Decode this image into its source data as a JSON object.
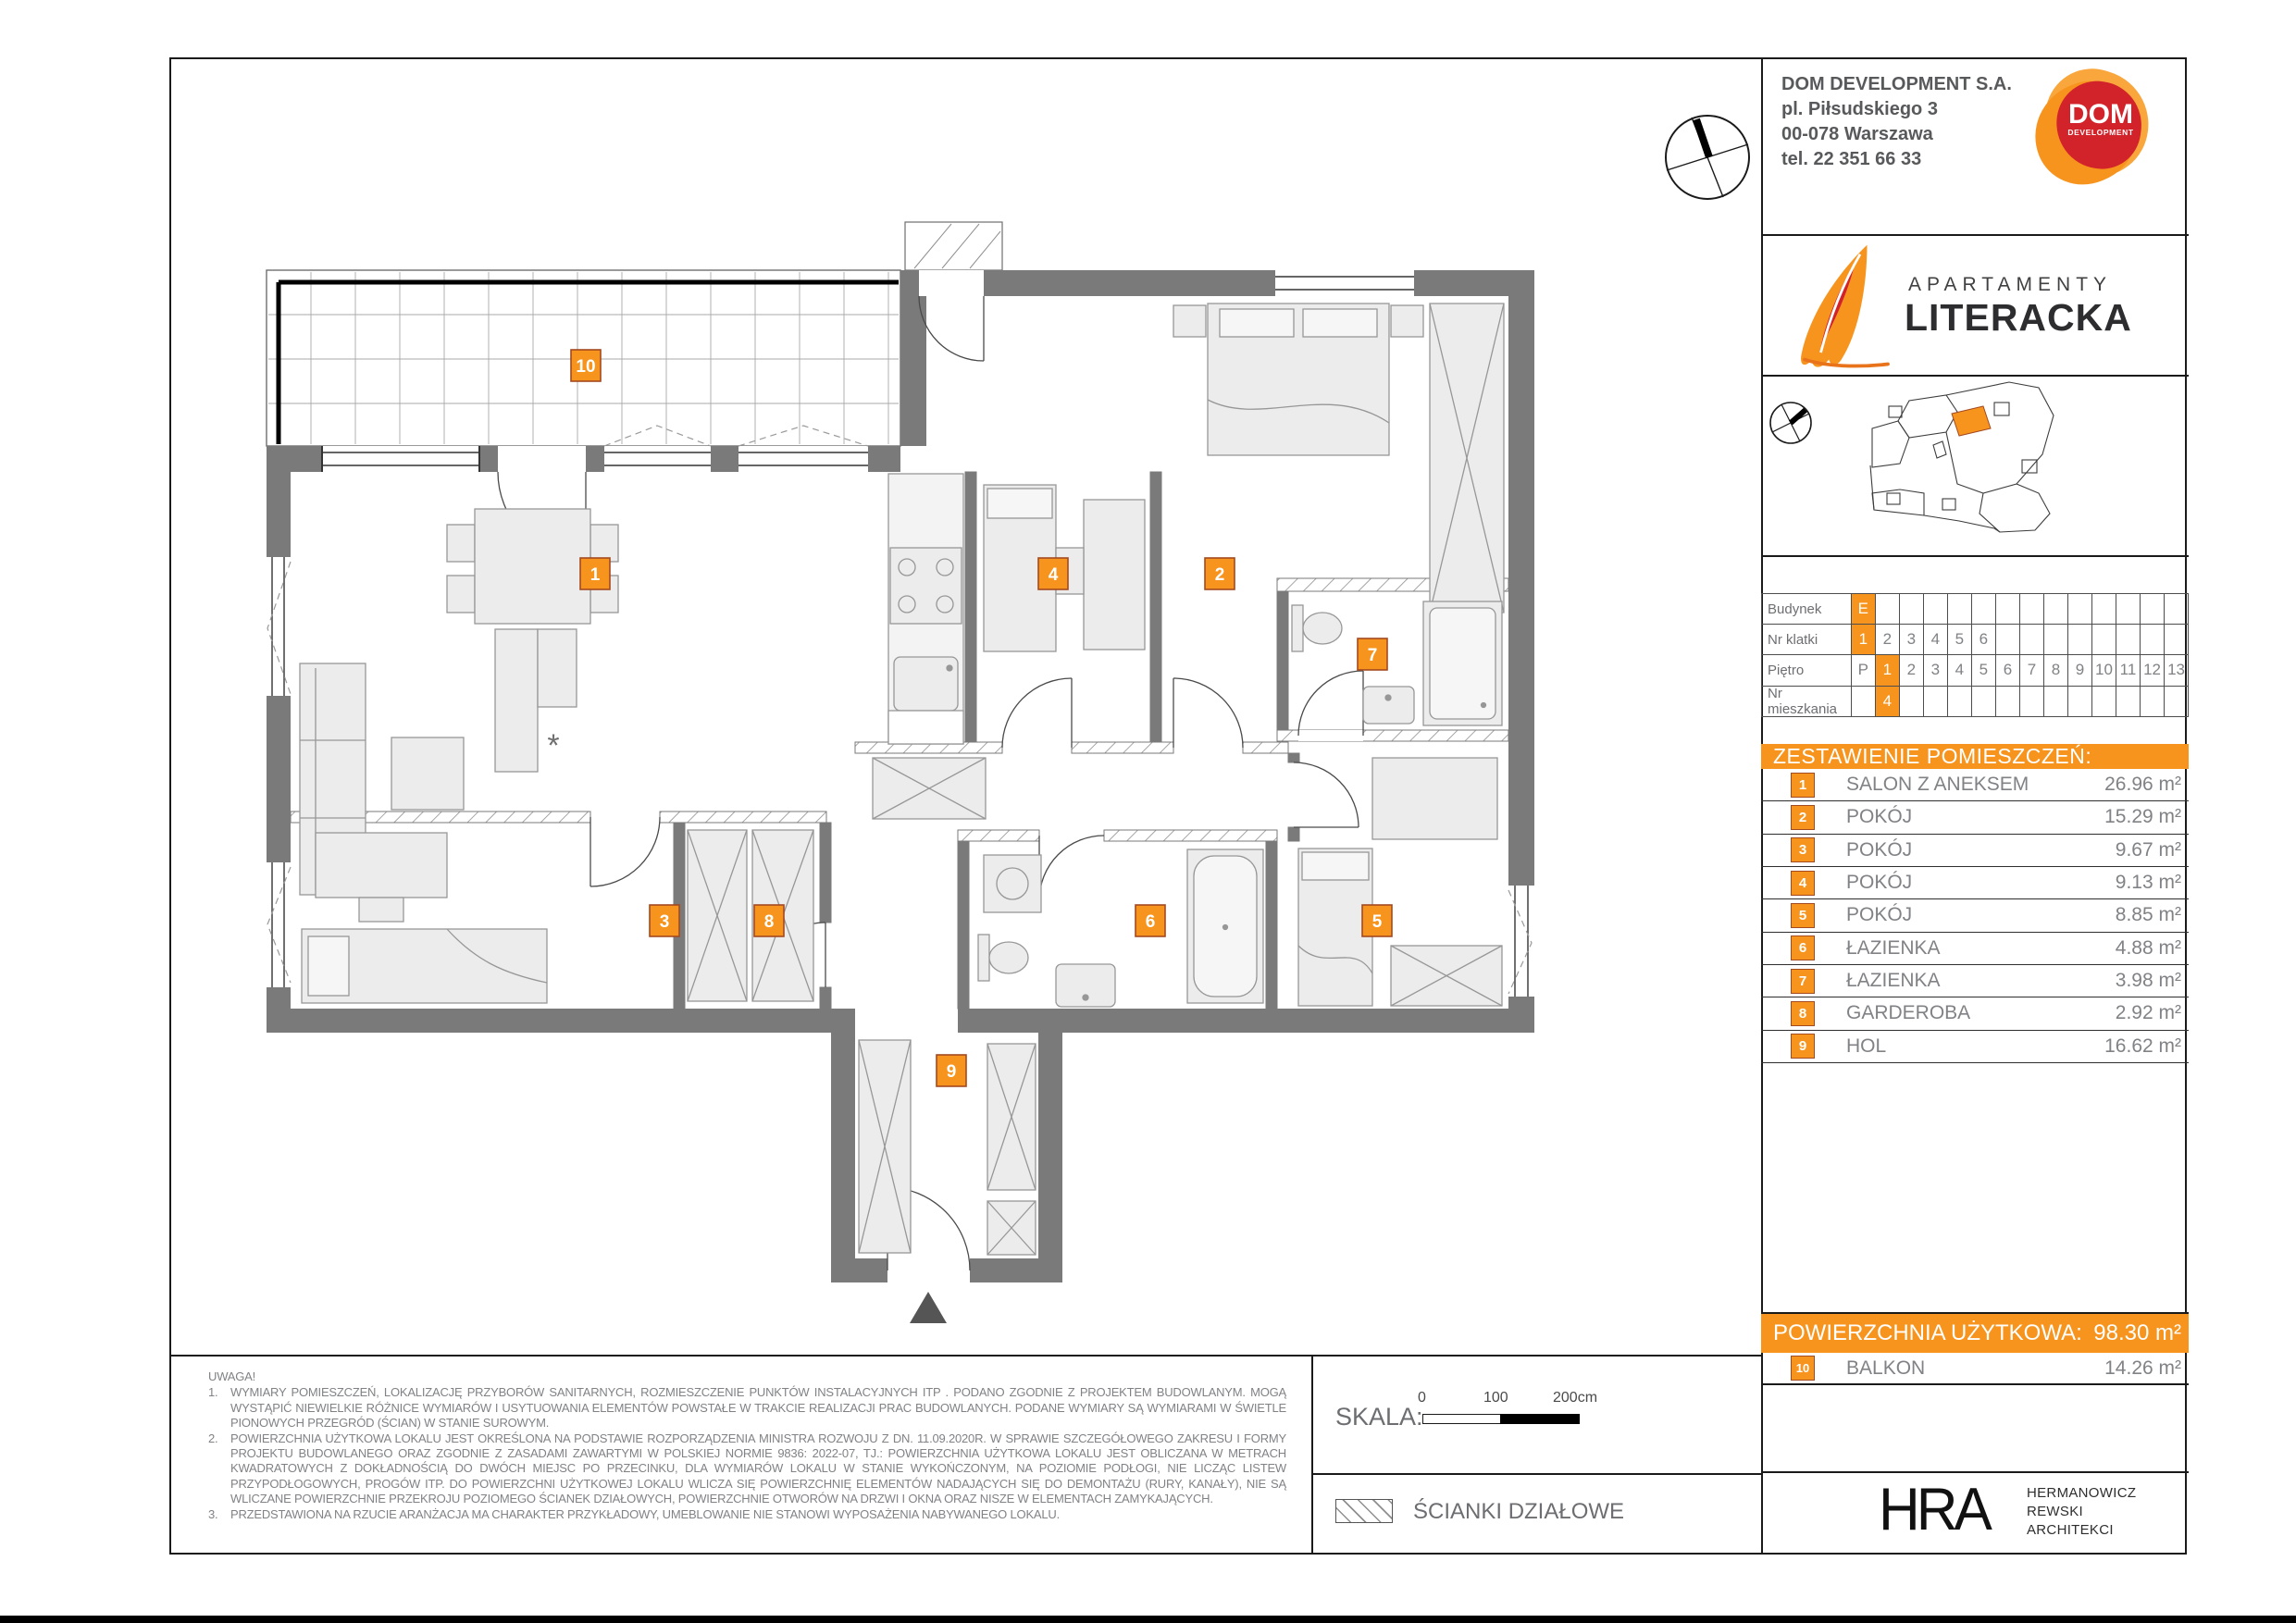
{
  "colors": {
    "accent": "#F7941E",
    "badge_border": "#A34A21",
    "wall": "#7a7a7a",
    "logo_red": "#D2232A"
  },
  "developer": {
    "name": "DOM DEVELOPMENT S.A.",
    "address_line1": "pl. Piłsudskiego 3",
    "address_line2": "00-078 Warszawa",
    "phone": "tel. 22 351 66 33",
    "logo_text": "DOM",
    "logo_subtext": "DEVELOPMENT"
  },
  "project": {
    "brand_top": "APARTAMENTY",
    "brand_name": "LITERACKA"
  },
  "unit_info": {
    "rows": [
      {
        "label": "Budynek",
        "cells": [
          "E",
          "",
          "",
          "",
          "",
          "",
          "",
          "",
          "",
          "",
          "",
          "",
          "",
          ""
        ],
        "highlight": [
          0
        ]
      },
      {
        "label": "Nr klatki",
        "cells": [
          "1",
          "2",
          "3",
          "4",
          "5",
          "6",
          "",
          "",
          "",
          "",
          "",
          "",
          "",
          ""
        ],
        "highlight": [
          0
        ]
      },
      {
        "label": "Piętro",
        "cells": [
          "P",
          "1",
          "2",
          "3",
          "4",
          "5",
          "6",
          "7",
          "8",
          "9",
          "10",
          "11",
          "12",
          "13"
        ],
        "highlight": [
          1
        ]
      },
      {
        "label": "Nr mieszkania",
        "cells": [
          "",
          "4",
          "",
          "",
          "",
          "",
          "",
          "",
          "",
          "",
          "",
          "",
          "",
          ""
        ],
        "highlight": [
          1
        ]
      }
    ]
  },
  "rooms_header": "ZESTAWIENIE POMIESZCZEŃ:",
  "rooms": [
    {
      "no": "1",
      "name": "SALON Z ANEKSEM",
      "area": "26.96 m²"
    },
    {
      "no": "2",
      "name": "POKÓJ",
      "area": "15.29 m²"
    },
    {
      "no": "3",
      "name": "POKÓJ",
      "area": "9.67 m²"
    },
    {
      "no": "4",
      "name": "POKÓJ",
      "area": "9.13 m²"
    },
    {
      "no": "5",
      "name": "POKÓJ",
      "area": "8.85 m²"
    },
    {
      "no": "6",
      "name": "ŁAZIENKA",
      "area": "4.88 m²"
    },
    {
      "no": "7",
      "name": "ŁAZIENKA",
      "area": "3.98 m²"
    },
    {
      "no": "8",
      "name": "GARDEROBA",
      "area": "2.92 m²"
    },
    {
      "no": "9",
      "name": "HOL",
      "area": "16.62 m²"
    }
  ],
  "total": {
    "label": "POWIERZCHNIA UŻYTKOWA:",
    "value": "98.30 m²"
  },
  "balcony_row": {
    "no": "10",
    "name": "BALKON",
    "area": "14.26 m²"
  },
  "plan": {
    "badges": [
      {
        "no": "1"
      },
      {
        "no": "2"
      },
      {
        "no": "3"
      },
      {
        "no": "4"
      },
      {
        "no": "5"
      },
      {
        "no": "6"
      },
      {
        "no": "7"
      },
      {
        "no": "8"
      },
      {
        "no": "9"
      },
      {
        "no": "10"
      }
    ]
  },
  "notes": {
    "title": "UWAGA!",
    "items": [
      {
        "no": "1.",
        "text": "WYMIARY POMIESZCZEŃ, LOKALIZACJĘ PRZYBORÓW SANITARNYCH, ROZMIESZCZENIE PUNKTÓW INSTALACYJNYCH ITP . PODANO ZGODNIE Z PROJEKTEM BUDOWLANYM. MOGĄ WYSTĄPIĆ NIEWIELKIE RÓŻNICE WYMIARÓW I USYTUOWANIA ELEMENTÓW POWSTAŁE W TRAKCIE REALIZACJI PRAC BUDOWLANYCH. PODANE WYMIARY SĄ WYMIARAMI W ŚWIETLE PIONOWYCH PRZEGRÓD (ŚCIAN) W STANIE SUROWYM."
      },
      {
        "no": "2.",
        "text": "POWIERZCHNIA UŻYTKOWA LOKALU JEST OKREŚLONA NA PODSTAWIE ROZPORZĄDZENIA MINISTRA ROZWOJU Z DN. 11.09.2020R. W SPRAWIE SZCZEGÓŁOWEGO ZAKRESU I FORMY PROJEKTU BUDOWLANEGO ORAZ ZGODNIE Z ZASADAMI ZAWARTYMI W POLSKIEJ NORMIE 9836: 2022-07, TJ.: POWIERZCHNIA UŻYTKOWA LOKALU JEST OBLICZANA W METRACH KWADRATOWYCH Z DOKŁADNOŚCIĄ DO DWÓCH MIEJSC PO PRZECINKU, DLA WYMIARÓW LOKALU W STANIE WYKOŃCZONYM, NA POZIOMIE PODŁOGI, NIE LICZĄC LISTEW PRZYPODŁOGOWYCH, PROGÓW ITP. DO POWIERZCHNI UŻYTKOWEJ LOKALU WLICZA SIĘ POWIERZCHNIĘ ELEMENTÓW NADAJĄCYCH SIĘ DO DEMONTAŻU (RURY, KANAŁY), NIE SĄ WLICZANE POWIERZCHNIE PRZEKROJU POZIOMEGO ŚCIANEK DZIAŁOWYCH, POWIERZCHNIE OTWORÓW NA DRZWI I OKNA ORAZ NISZE W ELEMENTACH ZAMYKAJĄCYCH."
      },
      {
        "no": "3.",
        "text": "PRZEDSTAWIONA NA RZUCIE ARANŻACJA MA CHARAKTER PRZYKŁADOWY, UMEBLOWANIE NIE STANOWI WYPOSAŻENIA NABYWANEGO LOKALU."
      }
    ]
  },
  "scale": {
    "label": "SKALA:",
    "ticks": [
      "0",
      "100",
      "200cm"
    ]
  },
  "legend": {
    "partition_label": "ŚCIANKI DZIAŁOWE"
  },
  "architect": {
    "abbr": "HRA",
    "lines": [
      "HERMANOWICZ",
      "REWSKI",
      "ARCHITEKCI"
    ]
  }
}
